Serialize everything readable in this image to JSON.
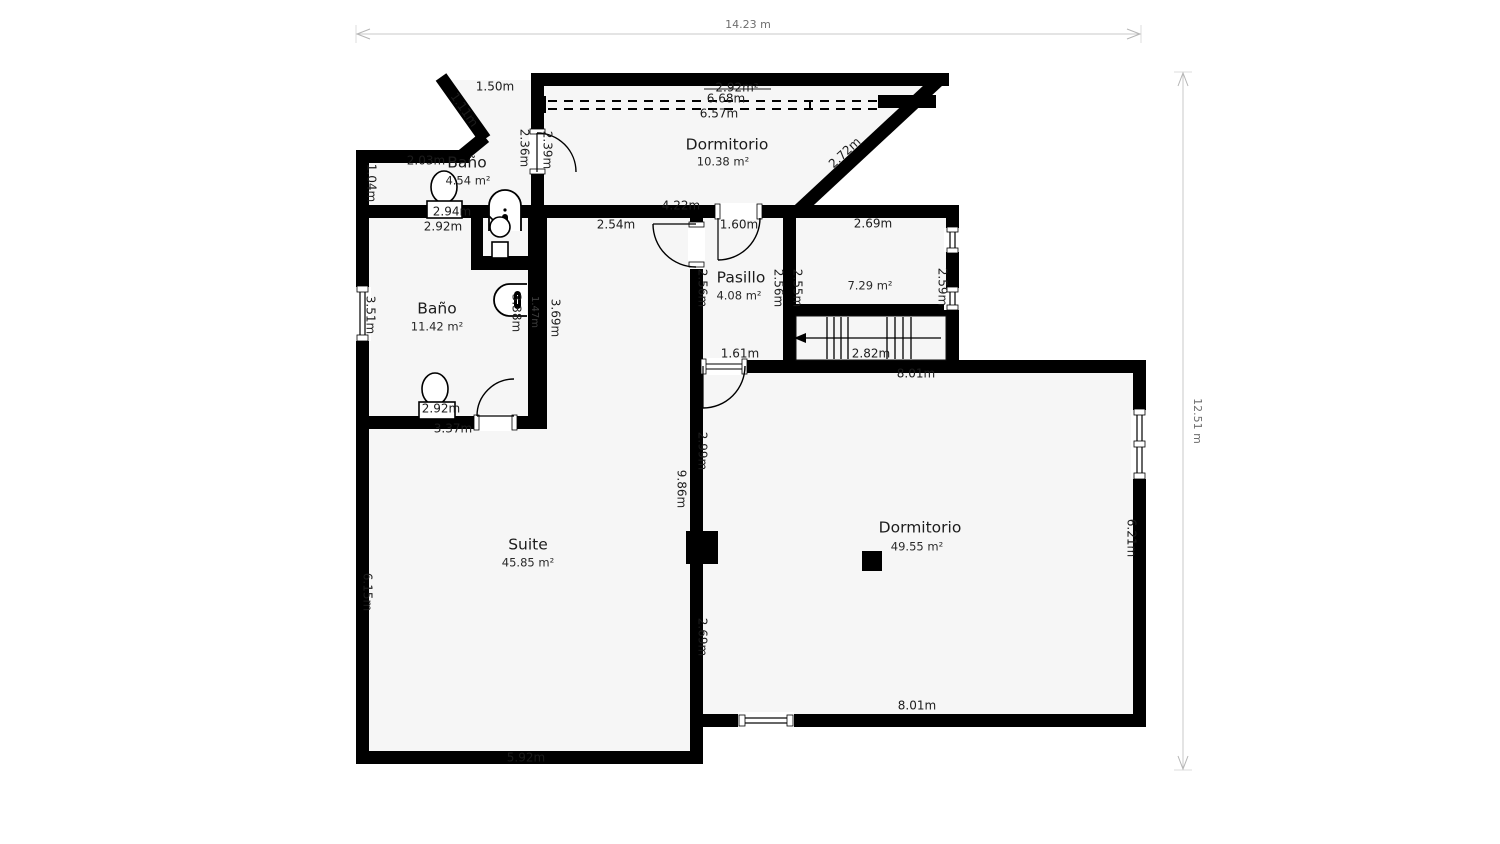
{
  "dimensions": {
    "width": "14.23 m",
    "height": "12.51 m"
  },
  "rooms": {
    "dormitorio_top": {
      "name": "Dormitorio",
      "area": "10.38 m²"
    },
    "bano_top": {
      "name": "Baño",
      "area": "4.54 m²"
    },
    "bano_main": {
      "name": "Baño",
      "area": "11.42 m²"
    },
    "pasillo": {
      "name": "Pasillo",
      "area": "4.08 m²"
    },
    "stairs_room": {
      "area": "7.29 m²"
    },
    "suite": {
      "name": "Suite",
      "area": "45.85 m²"
    },
    "dormitorio_main": {
      "name": "Dormitorio",
      "area": "49.55 m²"
    }
  },
  "measurements": {
    "top_150": "1.50m",
    "diag_111": "1.11m",
    "banoTop_203": "2.03m",
    "banoTop_104": "1.04m",
    "banoTop_294": "2.94m",
    "banoMain_292top": "2.92m",
    "wall_236": "2.36m",
    "door_239": "2.39m",
    "ceil_292": "2.92m²",
    "ceil_668": "6.68m",
    "ceil_657": "6.57m",
    "slope_272": "2.72m",
    "dormTop_422": "4.22m",
    "corr_254": "2.54m",
    "pas_160": "1.60m",
    "stairs_269": "2.69m",
    "pas_256L": "2.56m",
    "pas_256R": "2.56m",
    "stairs_255": "2.55m",
    "stairs_259": "2.59m",
    "stairs_282": "2.82m",
    "pas_161": "1.61m",
    "dorm2_801_top": "8.01m",
    "dorm2_299": "2.99m",
    "suite_986": "9.86m",
    "dorm2_269": "2.69m",
    "dorm2_621": "6.21m",
    "dorm2_801_bottom": "8.01m",
    "suite_592": "5.92m",
    "suite_615": "6.15m",
    "bano_351": "3.51m",
    "bano_338": "3.38m",
    "wall_147": "1.47m",
    "wall_369": "3.69m",
    "bano_292b": "2.92m",
    "bano_337": "3.37m"
  },
  "colors": {
    "wall": "#000000",
    "floor": "#f6f6f6",
    "dimension_line": "#c8c8c8",
    "text": "#1c1c1c"
  }
}
